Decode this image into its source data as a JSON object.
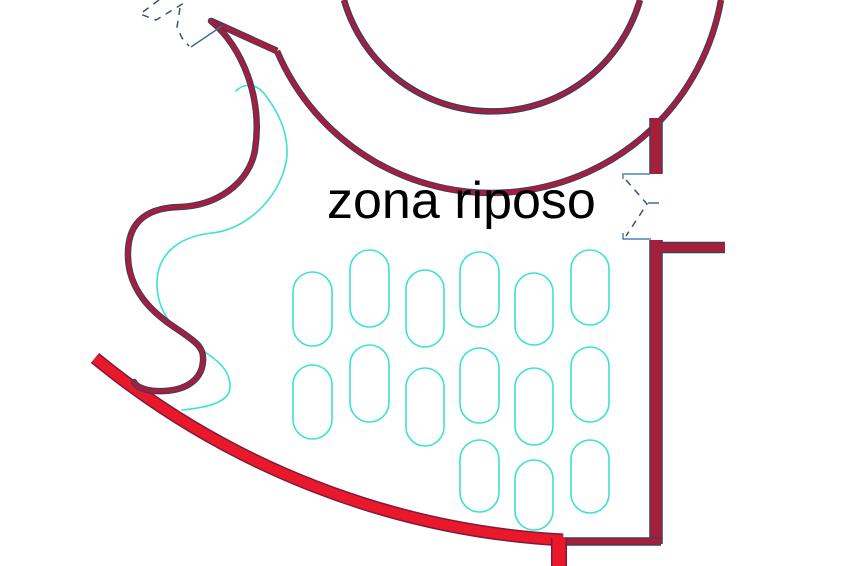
{
  "title": "zona riposo",
  "labels": {
    "zone": "zona riposo"
  },
  "colors": {
    "background": "#ffffff",
    "wall_crimson": "#a51f38",
    "edge_navy": "#363f6d",
    "band_bright_red": "#e9192b",
    "band_edge_dark": "#7e1a3a",
    "furniture_cyan": "#3ce1d6",
    "jamb_blue": "#4e84b4",
    "dash_blue": "#3a5570",
    "text_black": "#000000"
  },
  "plan": {
    "walls": {
      "inner_arc": "M 344 0 A 154 154 0 0 0 640 0",
      "outer_arc": "M 277 51 A 233 233 0 0 0 721 0",
      "apex_wall": "M 211 21 L 277 51",
      "s_wall": "M 211 21 C 242 46 263 98 255 150 C 249 184 216 206 179 207 C 141 208 127 227 128 257 C 129 290 151 312 177 329 C 198 343 204 348 203 361 C 202 379 187 390 164 391 C 149 392 137 388 134 382",
      "right_wall_top": "M 656 118 L 656 174",
      "right_wall_bottom": "M 656 240 L 656 544",
      "stub_wall": "M 660 247.5 L 725 247.5",
      "bottom_wall": "M 562 541.5 L 661 541.5"
    },
    "red_band": {
      "big_arc": "M 95 358 A 807 807 0 0 0 563 540",
      "end_stub": "M 559 538 L 559 566"
    },
    "cyan_offset_curve": "M 236 91 C 245 82 258 84 266 96 C 278 112 288 131 287 156 C 283 193 250 229 212 233 C 175 237 156 257 157 286 C 158 314 175 331 198 347 C 218 361 231 370 230 388 C 229 400 214 407 182 410",
    "chairs": [
      {
        "x": 293,
        "y": 272,
        "w": 39,
        "h": 74
      },
      {
        "x": 350,
        "y": 250,
        "w": 39,
        "h": 77
      },
      {
        "x": 406,
        "y": 270,
        "w": 38,
        "h": 77
      },
      {
        "x": 460,
        "y": 252,
        "w": 39,
        "h": 75
      },
      {
        "x": 515,
        "y": 273,
        "w": 38,
        "h": 72
      },
      {
        "x": 571,
        "y": 250,
        "w": 38,
        "h": 75
      },
      {
        "x": 293,
        "y": 365,
        "w": 39,
        "h": 74
      },
      {
        "x": 350,
        "y": 345,
        "w": 39,
        "h": 77
      },
      {
        "x": 406,
        "y": 368,
        "w": 38,
        "h": 78
      },
      {
        "x": 460,
        "y": 348,
        "w": 39,
        "h": 75
      },
      {
        "x": 515,
        "y": 368,
        "w": 38,
        "h": 77
      },
      {
        "x": 571,
        "y": 347,
        "w": 38,
        "h": 75
      },
      {
        "x": 460,
        "y": 440,
        "w": 39,
        "h": 72
      },
      {
        "x": 515,
        "y": 460,
        "w": 38,
        "h": 70
      },
      {
        "x": 571,
        "y": 440,
        "w": 38,
        "h": 73
      }
    ],
    "door": {
      "jamb_top": "M 623 179 L 623 174 L 650 174",
      "jamb_bottom": "M 623 233 L 623 239 L 651 239",
      "swing_dash": "M 626 180 L 647 204 L 626 236",
      "arrow_tick": "M 648 203 L 659 203"
    },
    "break_symbol": {
      "dash_zigzag": "M 159 0 L 140 14 L 156 20 L 184 3",
      "dash_drop": "M 180 8 L 177 27 L 182 38 L 189 46",
      "solid_link": "M 191 47 L 222 26"
    }
  }
}
